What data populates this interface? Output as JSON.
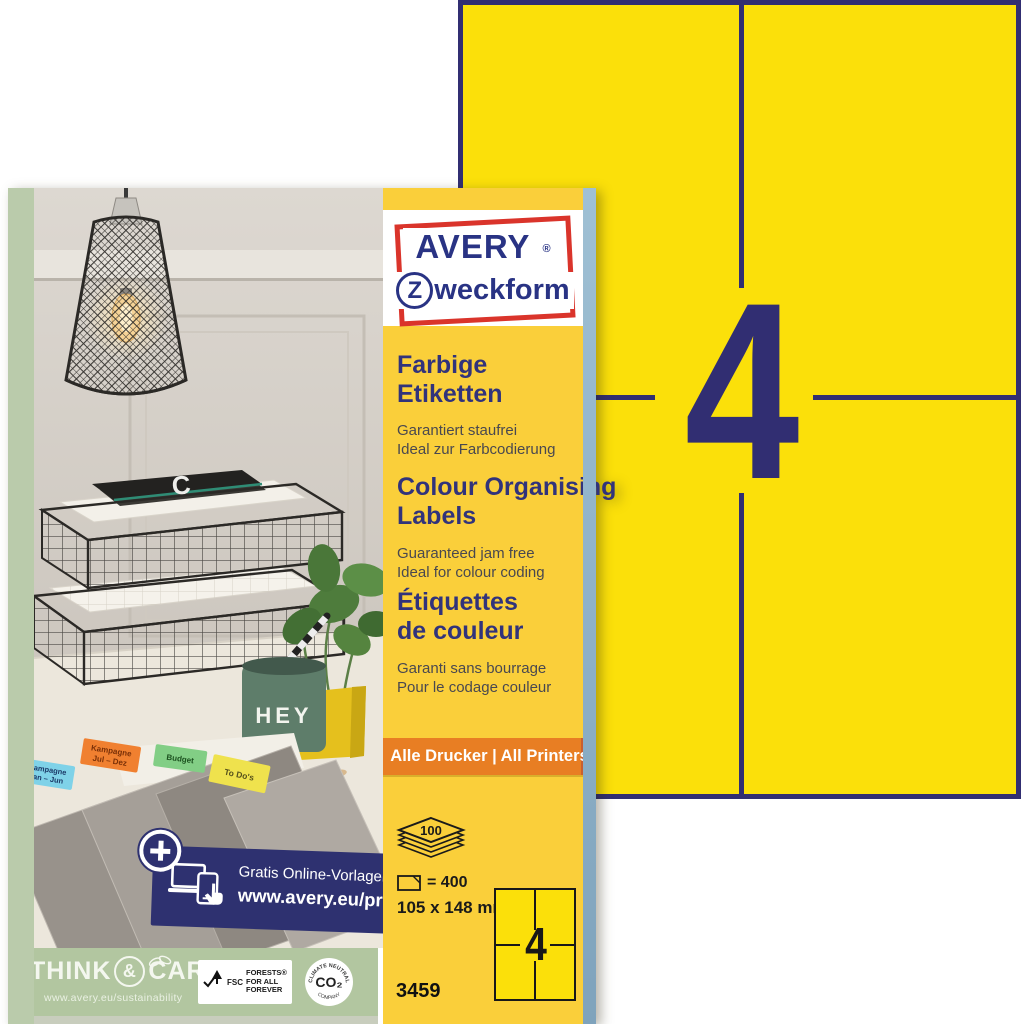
{
  "colors": {
    "sheet_yellow": "#FBE00A",
    "panel_yellow": "#FACF3A",
    "navy": "#312E72",
    "logo_red": "#DA342B",
    "orange_banner": "#E87E23",
    "banner_navy": "#2E3170",
    "green_strip": "#B2C6A0",
    "box_side_green": "#BACBAB",
    "box_side_blue": "#8FB4CC",
    "label_blue": "#7FD2E8",
    "label_orange": "#F08030",
    "label_green": "#82CE85",
    "label_yellow": "#EFE24D"
  },
  "big_sheet": {
    "label_count": "4"
  },
  "brand": {
    "avery": "AVERY",
    "registered": "®",
    "zweckform_z": "Z",
    "zweckform_rest": "weckform"
  },
  "sections": [
    {
      "title1": "Farbige",
      "title2": "Etiketten",
      "sub1": "Garantiert staufrei",
      "sub2": "Ideal zur Farbcodierung"
    },
    {
      "title1": "Colour Organising",
      "title2": "Labels",
      "sub1": "Guaranteed jam free",
      "sub2": "Ideal for colour coding"
    },
    {
      "title1": "Étiquettes",
      "title2": "de couleur",
      "sub1": "Garanti sans bourrage",
      "sub2": "Pour le codage couleur"
    }
  ],
  "printers_banner": "Alle Drucker | All Printers",
  "specs": {
    "sheet_count": "100",
    "label_equation": "= 400",
    "dimensions": "105 x 148 mm",
    "mini_label_count": "4",
    "product_number": "3459"
  },
  "online_banner": {
    "line1": "Gratis Online-Vorlagen:",
    "line2": "www.avery.eu/print"
  },
  "sustainability": {
    "think": "THINK",
    "amp": "&",
    "care": "CARE",
    "url": "www.avery.eu/sustainability",
    "fsc": "FSC",
    "fsc_line1": "FORESTS®",
    "fsc_line2": "FOR ALL",
    "fsc_line3": "FOREVER",
    "co2": "CO₂",
    "climate": "CLIMATE NEUTRAL",
    "company": "COMPANY"
  },
  "photo": {
    "mug_text": "HEY",
    "notebook_letter": "C",
    "folders": [
      {
        "line1": "Kampagne",
        "line2": "Jan – Jun"
      },
      {
        "line1": "Kampagne",
        "line2": "Jul – Dez"
      },
      {
        "line1": "Budget",
        "line2": ""
      },
      {
        "line1": "To Do's",
        "line2": ""
      }
    ]
  }
}
